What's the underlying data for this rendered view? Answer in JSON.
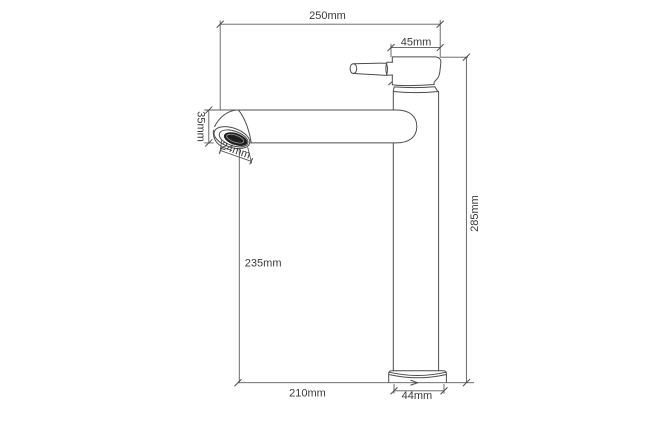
{
  "drawing": {
    "subject": "tall single-lever basin faucet, side elevation with dimensions",
    "unit": "mm"
  },
  "dimensions": {
    "overall_width": "250mm",
    "head_depth": "45mm",
    "spout_tube_diameter": "35mm",
    "aerator_diameter": "24mm",
    "spout_clearance_height": "235mm",
    "overall_height": "285mm",
    "spout_reach": "210mm",
    "base_diameter": "44mm"
  },
  "colors": {
    "background": "#ffffff",
    "drawing_line": "#4c4c4c",
    "dimension_line": "#5a5a5a",
    "label_text": "#3a3a3a",
    "aerator_fill": "#1f1f1f"
  }
}
